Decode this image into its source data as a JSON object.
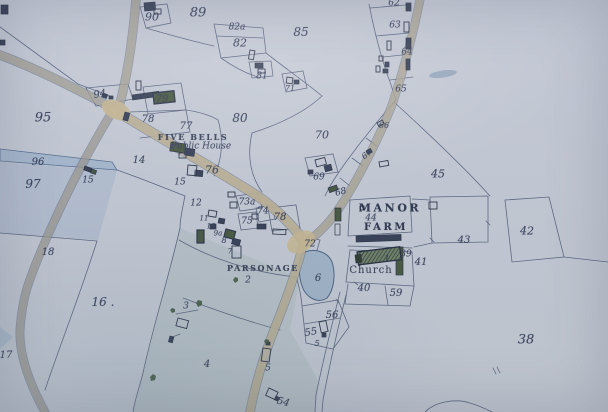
{
  "map": {
    "place_names": {
      "pub": "FIVE BELLS",
      "pub_subtitle": "Public House",
      "manor_line1": "MANOR",
      "manor_line2": "FARM",
      "church": "Church",
      "parsonage": "PARSONAGE"
    },
    "labels": [
      {
        "id": "n90",
        "text": "90",
        "x": 152,
        "y": 17,
        "s": 11
      },
      {
        "id": "n89",
        "text": "89",
        "x": 198,
        "y": 13,
        "s": 13
      },
      {
        "id": "n82a",
        "text": "82a",
        "x": 237,
        "y": 28,
        "s": 9
      },
      {
        "id": "n82",
        "text": "82",
        "x": 240,
        "y": 43,
        "s": 11
      },
      {
        "id": "n85",
        "text": "85",
        "x": 301,
        "y": 32,
        "s": 12
      },
      {
        "id": "n81",
        "text": "81",
        "x": 262,
        "y": 77,
        "s": 9
      },
      {
        "id": "n71",
        "text": "71",
        "x": 290,
        "y": 89,
        "s": 8
      },
      {
        "id": "n62",
        "text": "62",
        "x": 394,
        "y": 4,
        "s": 9
      },
      {
        "id": "n63",
        "text": "63",
        "x": 395,
        "y": 26,
        "s": 9
      },
      {
        "id": "n64",
        "text": "64",
        "x": 407,
        "y": 53,
        "s": 9
      },
      {
        "id": "n65",
        "text": "65",
        "x": 401,
        "y": 90,
        "s": 9
      },
      {
        "id": "n66",
        "text": "66",
        "x": 384,
        "y": 126,
        "s": 8
      },
      {
        "id": "n67",
        "text": "67",
        "x": 367,
        "y": 155,
        "s": 8,
        "r": -35
      },
      {
        "id": "n70",
        "text": "70",
        "x": 322,
        "y": 135,
        "s": 11
      },
      {
        "id": "n69",
        "text": "69",
        "x": 319,
        "y": 178,
        "s": 9
      },
      {
        "id": "n68",
        "text": "68",
        "x": 341,
        "y": 193,
        "s": 9,
        "r": -15
      },
      {
        "id": "n45",
        "text": "45",
        "x": 438,
        "y": 174,
        "s": 11
      },
      {
        "id": "n94",
        "text": "94",
        "x": 100,
        "y": 95,
        "s": 10,
        "r": -10
      },
      {
        "id": "n95",
        "text": "95",
        "x": 43,
        "y": 118,
        "s": 13
      },
      {
        "id": "n96",
        "text": "96",
        "x": 38,
        "y": 163,
        "s": 10
      },
      {
        "id": "n97",
        "text": "97",
        "x": 33,
        "y": 184,
        "s": 12
      },
      {
        "id": "n14",
        "text": "14",
        "x": 139,
        "y": 161,
        "s": 10
      },
      {
        "id": "n15w",
        "text": "15",
        "x": 88,
        "y": 181,
        "s": 9
      },
      {
        "id": "n79",
        "text": "79",
        "x": 162,
        "y": 100,
        "s": 10
      },
      {
        "id": "n78a",
        "text": "78",
        "x": 148,
        "y": 120,
        "s": 10
      },
      {
        "id": "n77",
        "text": "77",
        "x": 186,
        "y": 127,
        "s": 10
      },
      {
        "id": "pub",
        "text": "FIVE BELLS",
        "x": 193,
        "y": 137,
        "s": 8,
        "st": "caps"
      },
      {
        "id": "pub2",
        "text": "Public House",
        "x": 201,
        "y": 147,
        "s": 9,
        "st": "ital"
      },
      {
        "id": "n80",
        "text": "80",
        "x": 240,
        "y": 118,
        "s": 12
      },
      {
        "id": "n76",
        "text": "76",
        "x": 212,
        "y": 170,
        "s": 11
      },
      {
        "id": "n15",
        "text": "15",
        "x": 180,
        "y": 183,
        "s": 9
      },
      {
        "id": "n12",
        "text": "12",
        "x": 196,
        "y": 204,
        "s": 9
      },
      {
        "id": "n73a",
        "text": "73a",
        "x": 247,
        "y": 203,
        "s": 9
      },
      {
        "id": "n74",
        "text": "74",
        "x": 263,
        "y": 212,
        "s": 9
      },
      {
        "id": "n75",
        "text": "75",
        "x": 247,
        "y": 222,
        "s": 9
      },
      {
        "id": "n78b",
        "text": "78",
        "x": 280,
        "y": 218,
        "s": 10
      },
      {
        "id": "n72",
        "text": "72",
        "x": 310,
        "y": 245,
        "s": 9
      },
      {
        "id": "n11",
        "text": "11",
        "x": 204,
        "y": 219,
        "s": 7
      },
      {
        "id": "n10",
        "text": "10",
        "x": 211,
        "y": 227,
        "s": 7
      },
      {
        "id": "n9a",
        "text": "9a",
        "x": 218,
        "y": 234,
        "s": 7
      },
      {
        "id": "n8",
        "text": "8",
        "x": 224,
        "y": 241,
        "s": 8
      },
      {
        "id": "n7",
        "text": "7",
        "x": 230,
        "y": 252,
        "s": 7
      },
      {
        "id": "parsonage",
        "text": "PARSONAGE",
        "x": 263,
        "y": 268,
        "s": 8,
        "st": "caps"
      },
      {
        "id": "n2",
        "text": "2",
        "x": 248,
        "y": 281,
        "s": 9
      },
      {
        "id": "manor",
        "text": "MANOR",
        "x": 390,
        "y": 208,
        "s": 11,
        "st": "bold"
      },
      {
        "id": "n44",
        "text": "44",
        "x": 371,
        "y": 219,
        "s": 9
      },
      {
        "id": "farm",
        "text": "FARM",
        "x": 386,
        "y": 228,
        "s": 10,
        "st": "bold"
      },
      {
        "id": "n43",
        "text": "43",
        "x": 464,
        "y": 241,
        "s": 10
      },
      {
        "id": "n42",
        "text": "42",
        "x": 527,
        "y": 231,
        "s": 11
      },
      {
        "id": "n41",
        "text": "41",
        "x": 421,
        "y": 263,
        "s": 10
      },
      {
        "id": "n39",
        "text": "39",
        "x": 406,
        "y": 255,
        "s": 9
      },
      {
        "id": "n1",
        "text": "1",
        "x": 387,
        "y": 260,
        "s": 9
      },
      {
        "id": "church",
        "text": "Church",
        "x": 371,
        "y": 271,
        "s": 10,
        "st": "serif"
      },
      {
        "id": "n40",
        "text": "40",
        "x": 364,
        "y": 289,
        "s": 10
      },
      {
        "id": "n59",
        "text": "59",
        "x": 396,
        "y": 294,
        "s": 10
      },
      {
        "id": "n6",
        "text": "6",
        "x": 318,
        "y": 279,
        "s": 10
      },
      {
        "id": "n56",
        "text": "56",
        "x": 332,
        "y": 316,
        "s": 10
      },
      {
        "id": "n55",
        "text": "55",
        "x": 311,
        "y": 333,
        "s": 10,
        "r": -10
      },
      {
        "id": "n5b",
        "text": "5",
        "x": 317,
        "y": 344,
        "s": 8
      },
      {
        "id": "n38",
        "text": "38",
        "x": 526,
        "y": 340,
        "s": 13
      },
      {
        "id": "n16",
        "text": "16 .",
        "x": 103,
        "y": 302,
        "s": 12
      },
      {
        "id": "n18",
        "text": "18",
        "x": 48,
        "y": 253,
        "s": 10
      },
      {
        "id": "n17",
        "text": "17",
        "x": 6,
        "y": 356,
        "s": 10
      },
      {
        "id": "n3",
        "text": "3",
        "x": 186,
        "y": 307,
        "s": 9
      },
      {
        "id": "n4",
        "text": "4",
        "x": 207,
        "y": 365,
        "s": 10
      },
      {
        "id": "n5a",
        "text": "5",
        "x": 268,
        "y": 369,
        "s": 9
      },
      {
        "id": "n54",
        "text": "54",
        "x": 283,
        "y": 403,
        "s": 10,
        "r": 15
      }
    ],
    "colors": {
      "paper": "#c7ccd8",
      "ink": "#353e56",
      "road_tan": "#c7b999",
      "water": "#a3b6cc",
      "building_green": "#46573f",
      "label_ink": "#333b58"
    }
  }
}
